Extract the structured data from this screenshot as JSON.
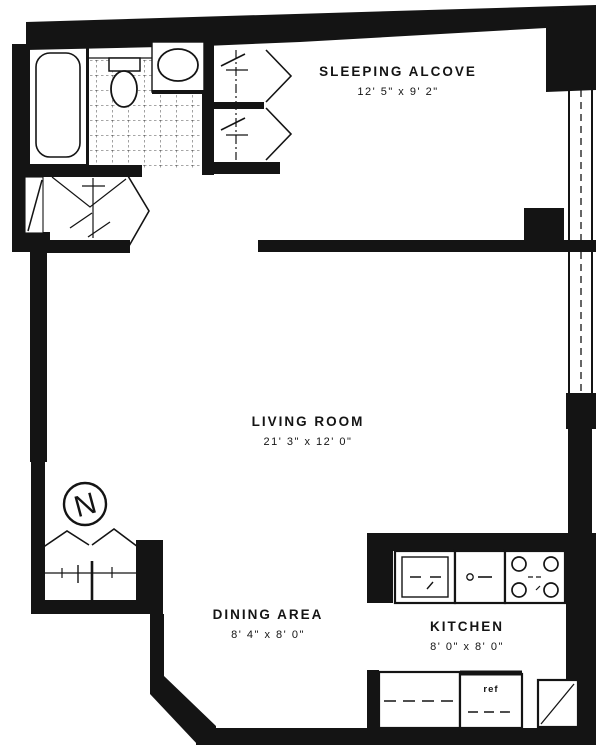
{
  "plan": {
    "type": "apartment-floor-plan",
    "colors": {
      "ink": "#141414",
      "paper": "#ffffff"
    },
    "rooms": [
      {
        "id": "sleeping-alcove",
        "name": "SLEEPING ALCOVE",
        "dims": "12' 5\" x 9' 2\""
      },
      {
        "id": "living-room",
        "name": "LIVING ROOM",
        "dims": "21' 3\" x 12' 0\""
      },
      {
        "id": "dining-area",
        "name": "DINING AREA",
        "dims": "8' 4\" x 8' 0\""
      },
      {
        "id": "kitchen",
        "name": "KITCHEN",
        "dims": "8' 0\" x 8' 0\""
      }
    ],
    "labels": {
      "north": "N",
      "refrigerator": "ref"
    },
    "fixtures": [
      "bathtub",
      "toilet",
      "bathroom-sink",
      "tiled-floor",
      "closets-with-bifold-doors",
      "closet-rods",
      "entry-door",
      "windows",
      "kitchen-sink",
      "dishwasher",
      "range-four-burner",
      "refrigerator",
      "corner-cabinet",
      "north-arrow"
    ]
  }
}
